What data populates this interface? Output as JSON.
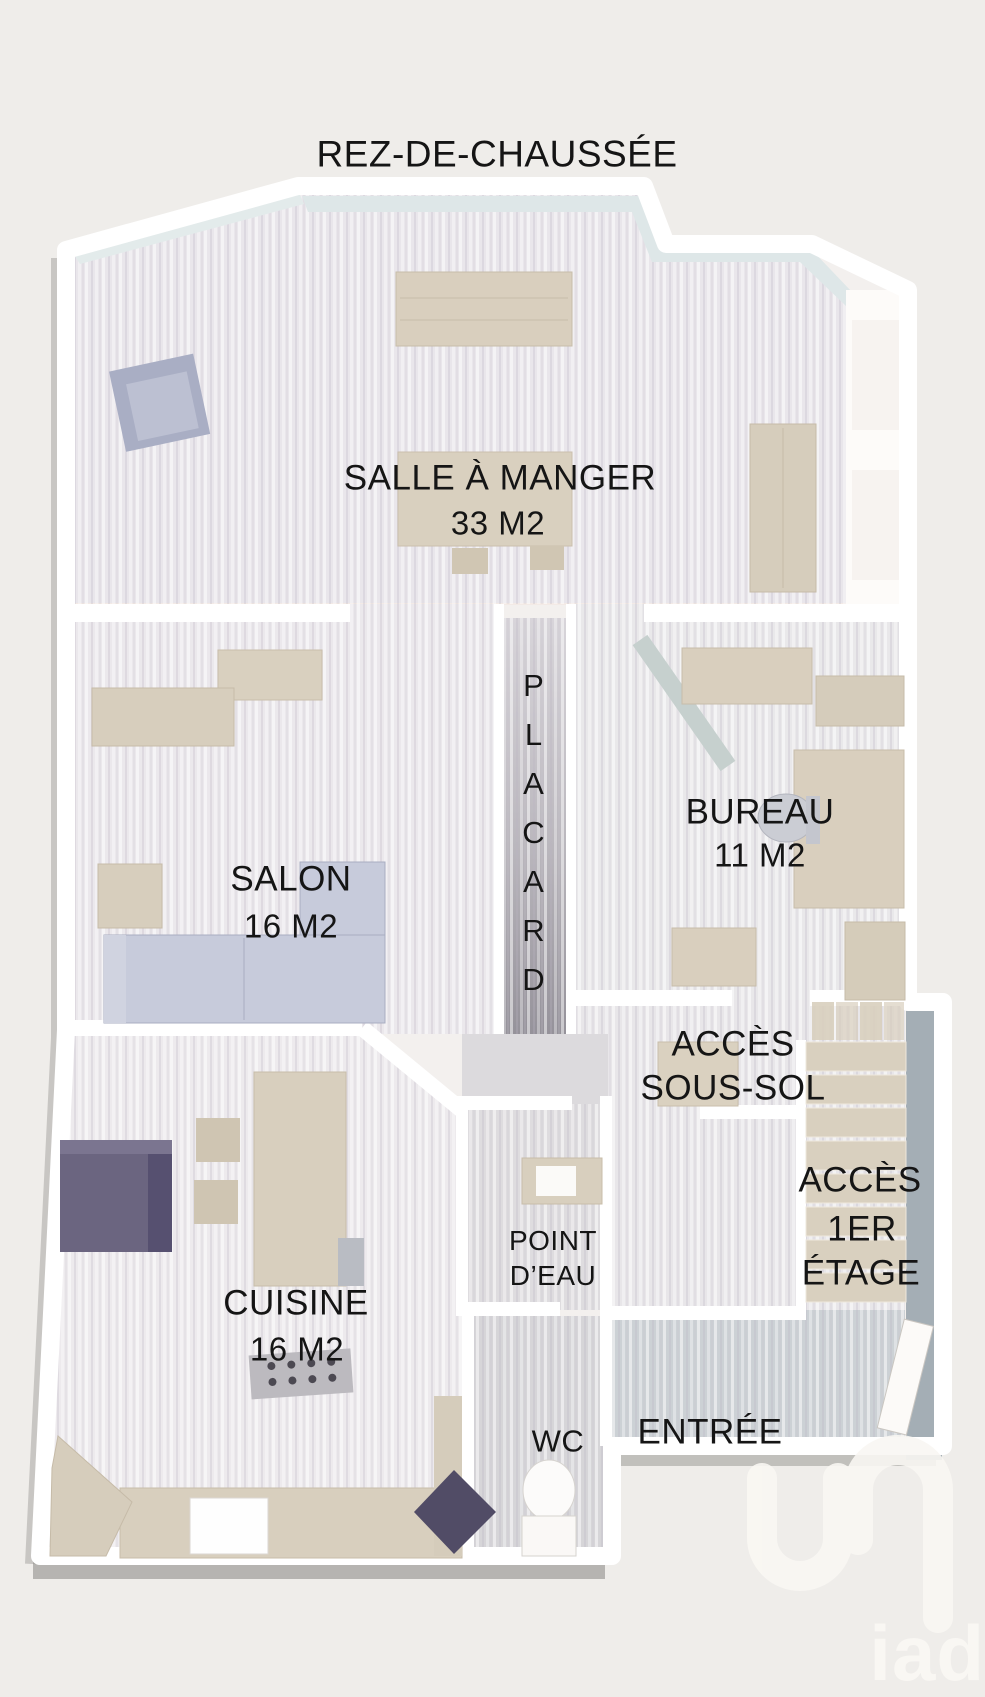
{
  "title": "REZ-DE-CHAUSSÉE",
  "rooms": {
    "salle_a_manger": {
      "name": "SALLE À MANGER",
      "area": "33 M2"
    },
    "salon": {
      "name": "SALON",
      "area": "16 M2"
    },
    "placard": {
      "name": "PLACARD"
    },
    "bureau": {
      "name": "BUREAU",
      "area": "11 M2"
    },
    "acces_sous_sol": {
      "line1": "ACCÈS",
      "line2": "SOUS-SOL"
    },
    "acces_1er_etage": {
      "line1": "ACCÈS",
      "line2": "1ER",
      "line3": "ÉTAGE"
    },
    "point_eau": {
      "line1": "POINT",
      "line2": "D’EAU"
    },
    "cuisine": {
      "name": "CUISINE",
      "area": "16 M2"
    },
    "wc": {
      "name": "WC"
    },
    "entree": {
      "name": "ENTRÉE"
    }
  },
  "watermark": {
    "brand": "iad"
  },
  "colors": {
    "background": "#efedea",
    "wall": "#ffffff",
    "floor_light": "#eae7ec",
    "floor_gray": "#d7d6d9",
    "entry_floor": "#ccd1d5",
    "furniture_beige": "#d8cfbe",
    "sofa_blue": "#c7cbdb",
    "accent_purple": "#6b6580",
    "accent_navy": "#514c66",
    "stair_wall_gray": "#a4aeb5",
    "label_color": "#151515",
    "watermark_color": "#f9f7f3"
  }
}
